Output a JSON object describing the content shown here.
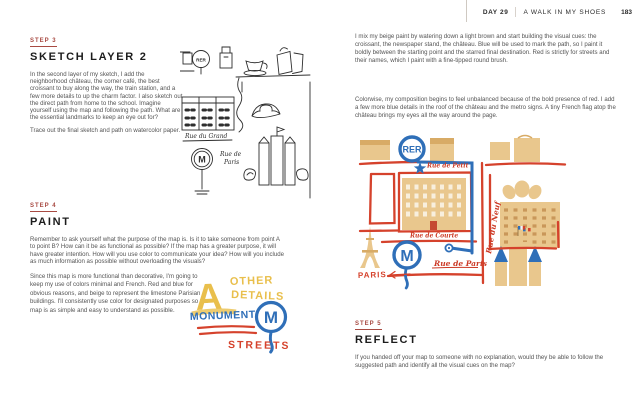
{
  "header": {
    "day": "DAY 29",
    "book_title": "A WALK IN MY SHOES",
    "page_number": "183"
  },
  "left_page": {
    "step3": {
      "label": "STEP 3",
      "heading": "SKETCH LAYER 2",
      "para1": "In the second layer of my sketch, I add the neighborhood château, the corner café, the best croissant to buy along the way, the train station, and a few more details to up the charm factor. I also sketch out the direct path from home to the school. Imagine yourself using the map and following the path. What are the essential landmarks to keep an eye out for?",
      "para2": "Trace out the final sketch and path on watercolor paper."
    },
    "step4": {
      "label": "STEP 4",
      "heading": "PAINT",
      "para1": "Remember to ask yourself what the purpose of the map is. Is it to take someone from point A to point B? How can it be as functional as possible? If the map has a greater purpose, it will have greater intention. How will you use color to communicate your idea? How will you include as much information as possible without overloading the visuals?",
      "para2": "Since this map is more functional than decorative, I'm going to keep my use of colors minimal and French. Red and blue for obvious reasons, and beige to represent the limestone Parisian buildings. I'll consistently use color for designated purposes so the map is as simple and easy to understand as possible."
    },
    "sketch": {
      "rer_sign": "RER",
      "metro_sign": "M",
      "street_label_1": "Rue du Grand",
      "street_label_2a": "Rue de",
      "street_label_2b": "Paris"
    },
    "color_key": {
      "letter_a": "A",
      "other": "OTHER",
      "details": "DETAILS",
      "monuments": "MONUMENTS",
      "metro_m": "M",
      "streets": "STREETS"
    }
  },
  "right_page": {
    "para1": "I mix my beige paint by watering down a light brown and start building the visual cues: the croissant, the newspaper stand, the château. Blue will be used to mark the path, so I paint it boldly between the starting point and the starred final destination. Red is strictly for streets and their names, which I paint with a fine-tipped round brush.",
    "para2": "Colorwise, my composition begins to feel unbalanced because of the bold presence of red. I add a few more blue details in the roof of the château and the metro signs. A tiny French flag atop the château brings my eyes all the way around the page.",
    "map": {
      "rer": "RER",
      "metro": "M",
      "street_top": "Rue de Pétit",
      "street_middle": "Rue de Courte",
      "street_bottom": "Rue de Paris",
      "street_right": "Rue du Neuf",
      "city": "PARIS"
    },
    "step5": {
      "label": "STEP 5",
      "heading": "REFLECT",
      "para1": "If you handed off your map to someone with no explanation, would they be able to follow the suggested path and identify all the visual cues on the map?"
    }
  },
  "colors": {
    "step_red": "#a84a42",
    "map_red": "#d5422c",
    "map_blue": "#2f6fb8",
    "beige": "#e9c78d",
    "beige_dark": "#d8ab66",
    "yellow": "#e9bf4c",
    "ink": "#2e2e2e"
  }
}
